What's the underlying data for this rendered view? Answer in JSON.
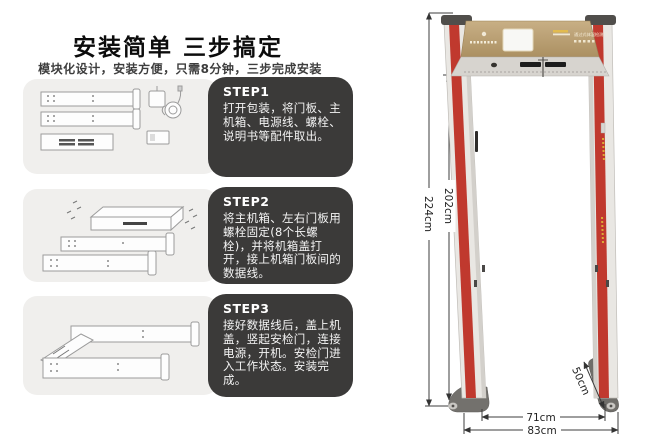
{
  "left_panel": {
    "title": "安装简单 三步搞定",
    "subtitle": "模块化设计，安装方便，只需8分钟，三步完成安装",
    "steps": [
      {
        "label": "STEP1",
        "text": "打开包装，将门板、主机箱、电源线、螺栓、说明书等配件取出。"
      },
      {
        "label": "STEP2",
        "text": "将主机箱、左右门板用螺栓固定(8个长螺栓)，并将机箱盖打开，接上机箱门板间的数据线。"
      },
      {
        "label": "STEP3",
        "text": "接好数据线后，盖上机盖，竖起安检门，连接电源，开机。安检门进入工作状态。安装完成。"
      }
    ]
  },
  "detector": {
    "panel_text": "通过式体温检测门",
    "dimensions": {
      "outer_height": "224cm",
      "inner_height": "202cm",
      "base_depth": "50cm",
      "inner_width": "71cm",
      "outer_width": "83cm"
    },
    "colors": {
      "header_gold": "#bda27a",
      "led_red": "#c0392e",
      "pillar": "#e9e7e3",
      "step_box": "#3b3a39",
      "illustration_bg": "#f0efed"
    }
  }
}
